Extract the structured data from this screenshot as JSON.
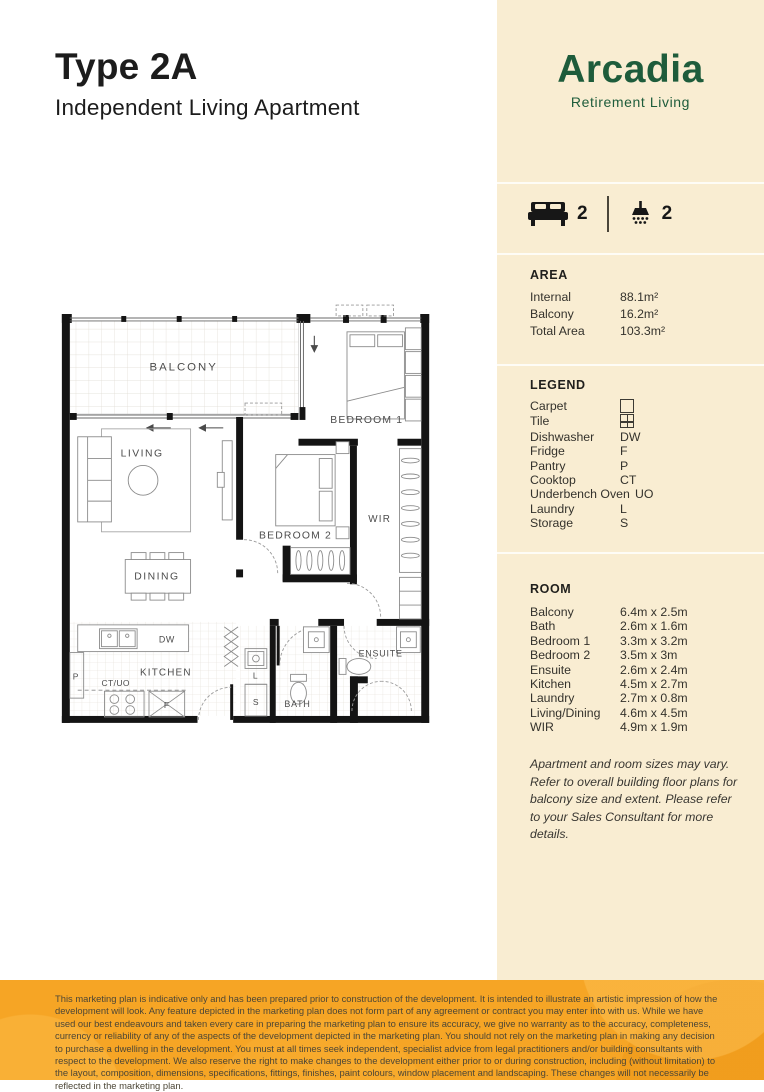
{
  "header": {
    "title": "Type 2A",
    "subtitle": "Independent Living Apartment"
  },
  "brand": {
    "name": "Arcadia",
    "tagline": "Retirement Living",
    "green": "#1e5c3b",
    "panel_bg": "#f9edd2"
  },
  "summary": {
    "bed_icon": "bed-icon",
    "bedrooms": "2",
    "shower_icon": "shower-icon",
    "bathrooms": "2"
  },
  "area": {
    "heading": "AREA",
    "rows": [
      {
        "label": "Internal",
        "value": "88.1m²"
      },
      {
        "label": "Balcony",
        "value": "16.2m²"
      },
      {
        "label": "Total Area",
        "value": "103.3m²"
      }
    ]
  },
  "legend": {
    "heading": "LEGEND",
    "rows": [
      {
        "label": "Carpet",
        "code": "",
        "icon": "carpet-swatch"
      },
      {
        "label": "Tile",
        "code": "",
        "icon": "tile-swatch"
      },
      {
        "label": "Dishwasher",
        "code": "DW"
      },
      {
        "label": "Fridge",
        "code": "F"
      },
      {
        "label": "Pantry",
        "code": "P"
      },
      {
        "label": "Cooktop",
        "code": "CT"
      },
      {
        "label": "Underbench Oven",
        "code": "UO"
      },
      {
        "label": "Laundry",
        "code": "L"
      },
      {
        "label": "Storage",
        "code": "S"
      }
    ]
  },
  "room": {
    "heading": "ROOM",
    "rows": [
      {
        "label": "Balcony",
        "value": "6.4m x 2.5m"
      },
      {
        "label": "Bath",
        "value": "2.6m x 1.6m"
      },
      {
        "label": "Bedroom 1",
        "value": "3.3m x 3.2m"
      },
      {
        "label": "Bedroom 2",
        "value": "3.5m x 3m"
      },
      {
        "label": "Ensuite",
        "value": "2.6m x 2.4m"
      },
      {
        "label": "Kitchen",
        "value": "4.5m x 2.7m"
      },
      {
        "label": "Laundry",
        "value": "2.7m x 0.8m"
      },
      {
        "label": "Living/Dining",
        "value": "4.6m x 4.5m"
      },
      {
        "label": "WIR",
        "value": "4.9m x 1.9m"
      }
    ]
  },
  "note": "Apartment and room sizes may vary. Refer to overall building floor plans for balcony size and extent. Please refer to your Sales Consultant for more details.",
  "floorplan": {
    "labels": {
      "balcony": "BALCONY",
      "bedroom1": "BEDROOM 1",
      "bedroom2": "BEDROOM 2",
      "living": "LIVING",
      "dining": "DINING",
      "kitchen": "KITCHEN",
      "wir": "WIR",
      "bath": "BATH",
      "ensuite": "ENSUITE",
      "dw": "DW",
      "ct_uo": "CT/UO",
      "fridge": "F",
      "pantry": "P",
      "laundry": "L",
      "storage": "S"
    }
  },
  "footer": {
    "bg": "#f6a525",
    "text": "This marketing plan is indicative only and has been prepared prior to construction of the development. It is intended to illustrate an artistic impression of how the development will look. Any feature depicted in the marketing plan does not form part of any agreement or contract you may enter into with us. While we have used our best endeavours and taken every care in preparing the marketing plan to ensure its accuracy, we give no warranty as to the accuracy, completeness, currency or reliability of any of the aspects of the development depicted in the marketing plan. You should not rely on the marketing plan in making any decision to purchase a dwelling in the development. You must at all times seek independent, specialist advice from legal practitioners and/or building consultants with respect to the development. We also reserve the right to make changes to the development either prior to or during construction, including (without limitation) to the layout, composition, dimensions, specifications, fittings, finishes, paint colours, window placement and landscaping. These changes will not necessarily be reflected in the marketing plan."
  }
}
